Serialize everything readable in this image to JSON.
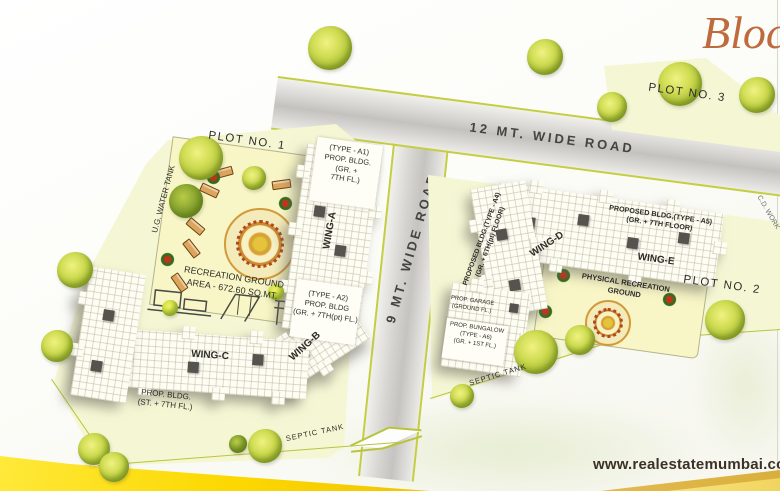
{
  "brand": "Block",
  "footer": {
    "website": "www.realestatemumbai.com"
  },
  "roads": {
    "road12": "12 MT. WIDE ROAD",
    "road9": "9 MT. WIDE ROAD",
    "edge_note": "C.D. WORK"
  },
  "plot1": {
    "label": "PLOT NO. 1",
    "water_tank": "U.G. WATER TANK",
    "recreation": "RECREATION GROUND\nAREA - 672.60 SQ.MT.",
    "wing_a_label": "WING-A",
    "wing_b_label": "WING-B",
    "wing_c_label": "WING-C",
    "bldg_a1": "(TYPE - A1)\nPROP. BLDG.\n(GR. +\n7TH FL.)",
    "bldg_a2": "(TYPE - A2)\nPROP. BLDG\n(GR. + 7TH(pt) FL.)",
    "bldg_c": "PROP. BLDG.\n(ST. + 7TH FL.)",
    "septic_tank": "SEPTIC TANK"
  },
  "plot2": {
    "label": "PLOT NO. 2",
    "wing_d_label": "WING-D",
    "wing_e_label": "WING-E",
    "bldg_a4": "PROPOSED BLDG.(TYPE - A4)\n(GR. + 6TH(pt) FLOOR)",
    "bldg_a5": "PROPOSED BLDG.(TYPE - A5)\n(GR. + 7TH FLOOR)",
    "physical_recreation": "PHYSICAL RECREATION\nGROUND",
    "garage": "PROP. GARAGE\n(GROUND FL.)",
    "bungalow": "PROP. BUNGALOW\n(TYPE - A6)\n(GR. + 1ST FL.)",
    "septic_tank": "SEPTIC TANK"
  },
  "plot3": {
    "label": "PLOT NO. 3"
  },
  "colors": {
    "plot_fill": "#f5f7d4",
    "plot_border": "#b9c43d",
    "road_fill": "#d6d4d0",
    "title_accent": "#bf6a3e",
    "bottom_band_yellow": "#ffdf00",
    "tree_green": "#a9bc34",
    "mandala_orange": "#cc8a2e"
  }
}
